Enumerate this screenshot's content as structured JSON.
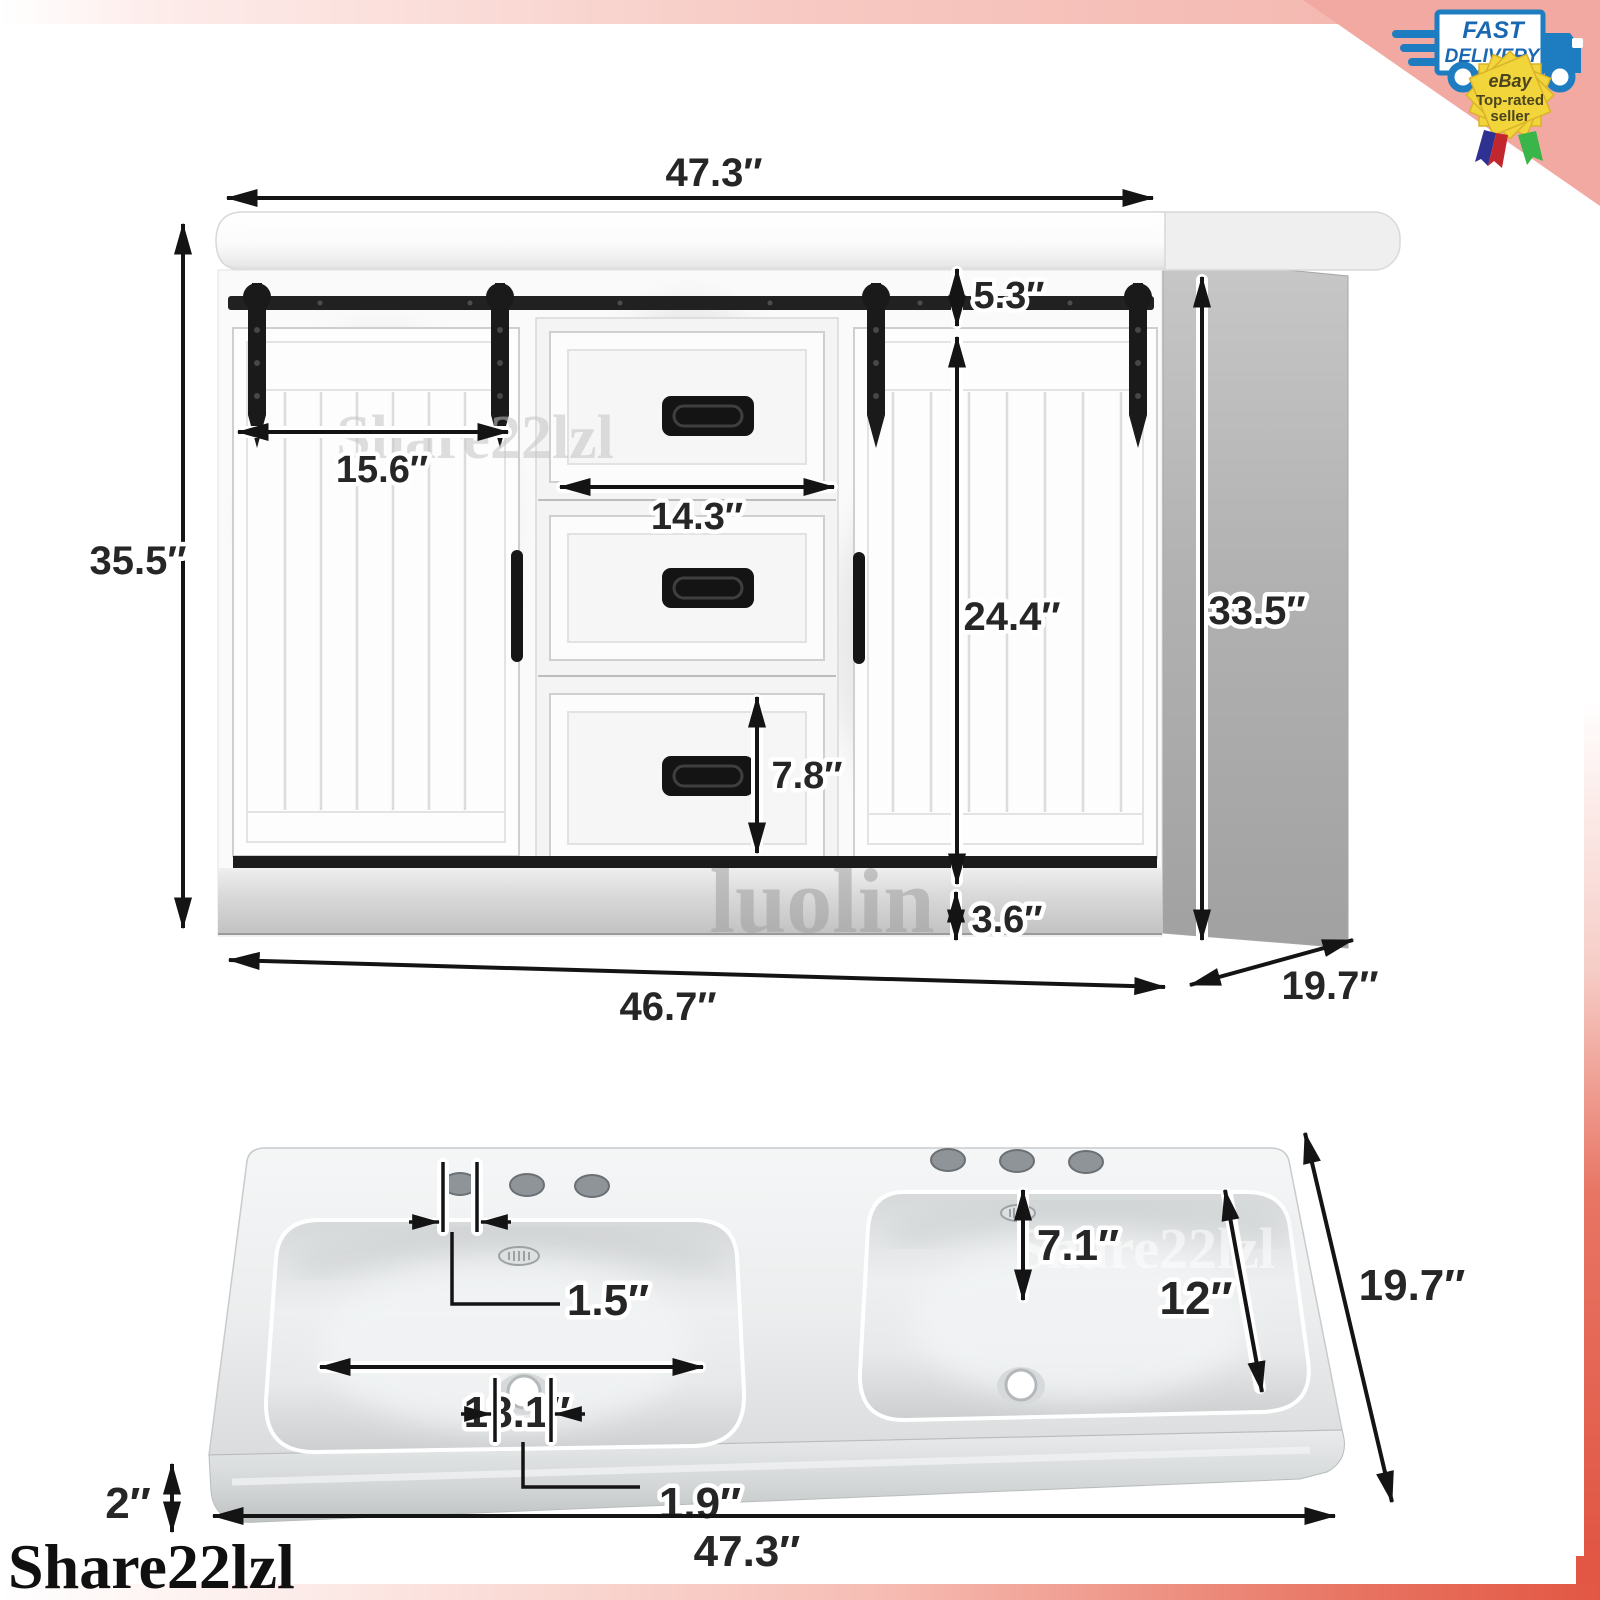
{
  "badges": {
    "fast_delivery": {
      "line1": "FAST",
      "line2": "DELIVERY"
    },
    "ebay_badge": {
      "line1": "eBay",
      "line2": "Top-rated",
      "line3": "seller"
    }
  },
  "watermarks": {
    "cabinet": "Share22lzl",
    "toekick": "luolin",
    "sink": "Share22lzl",
    "logo": "Share22lzl"
  },
  "cabinet_dims": {
    "top_width": "47.3″",
    "overall_height": "35.5″",
    "door_width": "15.6″",
    "drawer_width": "14.3″",
    "rail_gap": "5.3″",
    "door_height": "24.4″",
    "side_height": "33.5″",
    "drawer_height": "7.8″",
    "toekick_height": "3.6″",
    "bottom_width": "46.7″",
    "depth": "19.7″"
  },
  "sink_dims": {
    "hole_diameter": "1.5″",
    "hole_to_basin": "7.1″",
    "basin_width": "18.1″",
    "basin_depth": "12″",
    "depth": "19.7″",
    "edge_thickness": "2″",
    "drain_diameter": "1.9″",
    "overall_width": "47.3″"
  },
  "colors": {
    "frame_pink": "#f1a9a2",
    "frame_coral": "#e25743",
    "truck_blue": "#1e7dc0",
    "badge_yellow": "#f2d43b",
    "ribbon_red": "#c1272d",
    "ribbon_navy": "#2e3192",
    "ribbon_green": "#39b54a",
    "hardware_black": "#1a1a1a"
  }
}
